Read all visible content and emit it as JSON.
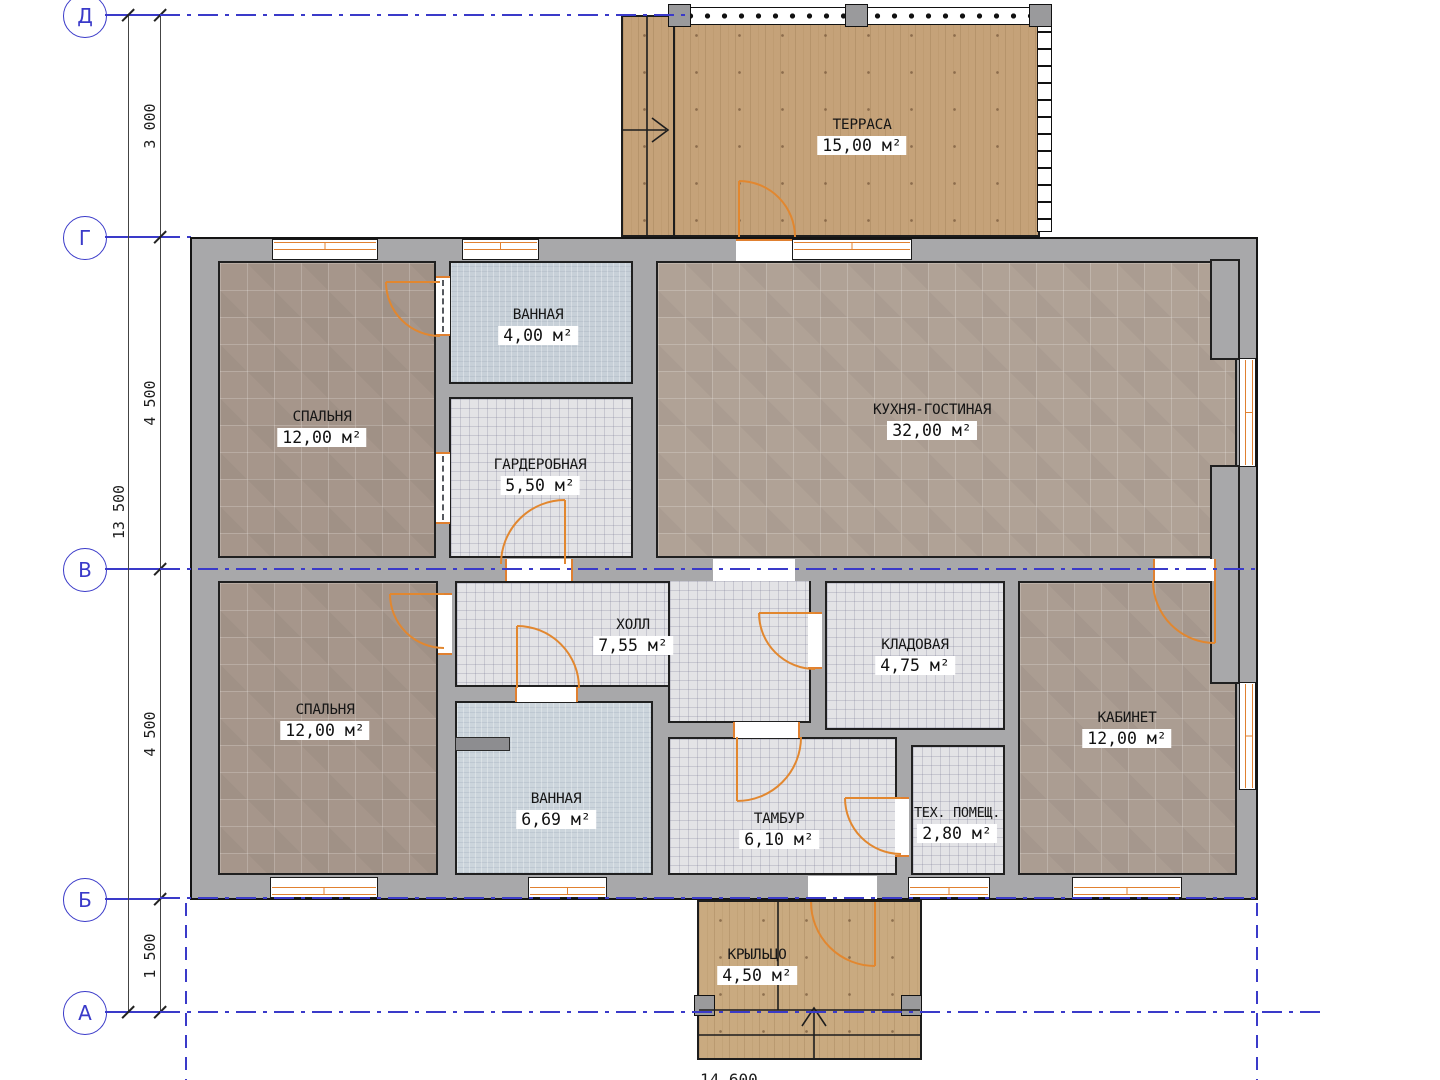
{
  "axes": [
    {
      "label": "Д"
    },
    {
      "label": "Г"
    },
    {
      "label": "В"
    },
    {
      "label": "Б"
    },
    {
      "label": "А"
    }
  ],
  "dims": {
    "total_left": "13 500",
    "seg_d_g": "3 000",
    "seg_g_v": "4 500",
    "seg_v_b": "4 500",
    "seg_b_a": "1 500",
    "bottom_partial": "14 600"
  },
  "rooms": [
    {
      "name": "ТЕРРАСА",
      "area": "15,00 м²"
    },
    {
      "name": "СПАЛЬНЯ",
      "area": "12,00 м²"
    },
    {
      "name": "ВАННАЯ",
      "area": "4,00 м²"
    },
    {
      "name": "ГАРДЕРОБНАЯ",
      "area": "5,50 м²"
    },
    {
      "name": "КУХНЯ-ГОСТИНАЯ",
      "area": "32,00 м²"
    },
    {
      "name": "СПАЛЬНЯ",
      "area": "12,00 м²"
    },
    {
      "name": "ХОЛЛ",
      "area": "7,55 м²"
    },
    {
      "name": "КЛАДОВАЯ",
      "area": "4,75 м²"
    },
    {
      "name": "ВАННАЯ",
      "area": "6,69 м²"
    },
    {
      "name": "ТАМБУР",
      "area": "6,10 м²"
    },
    {
      "name": "ТЕХ. ПОМЕЩ.",
      "area": "2,80 м²"
    },
    {
      "name": "КАБИНЕТ",
      "area": "12,00 м²"
    },
    {
      "name": "КРЫЛЬЦО",
      "area": "4,50 м²"
    }
  ],
  "colors": {
    "axis_blue": "#3a3ac9",
    "wall_gray": "#a8a8aa",
    "door_orange": "#e08030",
    "tile_brown": "#ab9b8f",
    "tile_fine": "#e3e3e6",
    "tile_blue": "#c7d0d8",
    "wood": "#c5a279"
  }
}
